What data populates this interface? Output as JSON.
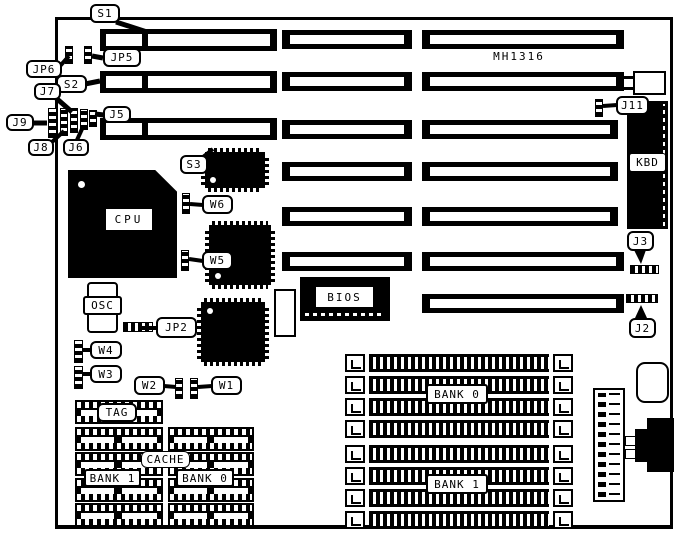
{
  "board": {
    "model": "MH1316"
  },
  "callouts": {
    "s1": "S1",
    "jp5": "JP5",
    "jp6": "JP6",
    "s2": "S2",
    "j7": "J7",
    "j9": "J9",
    "j8": "J8",
    "j6": "J6",
    "j5": "J5",
    "s3": "S3",
    "j11": "J11",
    "w6": "W6",
    "w5": "W5",
    "jp2": "JP2",
    "w4": "W4",
    "w3": "W3",
    "w2": "W2",
    "w1": "W1",
    "j3": "J3",
    "j2": "J2"
  },
  "components": {
    "cpu": "CPU",
    "osc": "OSC",
    "bios": "BIOS",
    "kbd": "KBD",
    "tag": "TAG",
    "cache": "CACHE",
    "dip_bank1": "BANK 1",
    "dip_bank0": "BANK 0",
    "simm_bank0": "BANK 0",
    "simm_bank1": "BANK 1"
  },
  "colors": {
    "ink": "#000000",
    "paper": "#ffffff"
  }
}
